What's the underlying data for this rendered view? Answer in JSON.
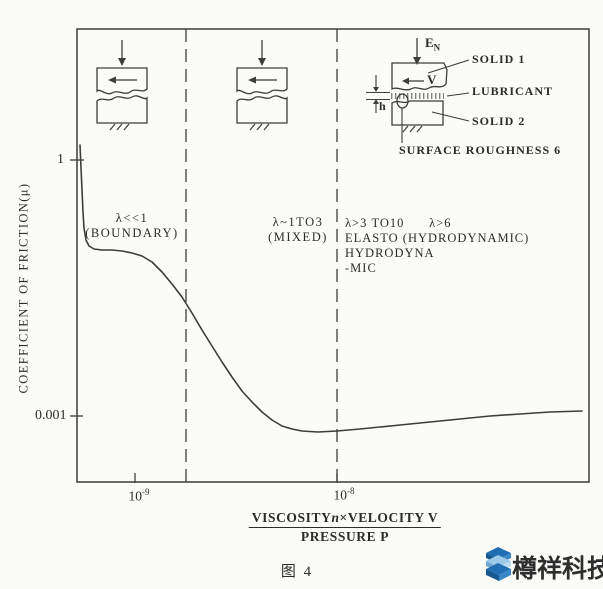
{
  "figure": {
    "caption": "图 4",
    "ink_color": "#3d3d3d",
    "background_color": "#fbfbf8"
  },
  "yaxis": {
    "title": "COEFFICIENT OF FRICTION(μ)",
    "tick_top": "1",
    "tick_bottom": "0.001"
  },
  "xaxis": {
    "tick1": {
      "base": "10",
      "exp": "-9"
    },
    "tick2": {
      "base": "10",
      "exp": "-8"
    },
    "numerator_pre": "VISCOSITY",
    "numerator_var": "n",
    "numerator_post": "×VELOCITY V",
    "denominator": "PRESSURE P"
  },
  "regions": {
    "boundary": {
      "line1": "λ<<1",
      "line2": "(BOUNDARY)"
    },
    "mixed": {
      "line1": "λ~1TO3",
      "line2": "(MIXED)"
    },
    "hydrodynamic": {
      "line1": "λ>3 TO10      λ>6",
      "line2": "ELASTO (HYDRODYNAMIC)",
      "line3": "HYDRODYNA",
      "line4": "-MIC"
    }
  },
  "inset": {
    "load_base": "E",
    "load_sub": "N",
    "velocity": "V",
    "film_thickness": "h",
    "solid1": "SOLID 1",
    "lubricant": "LUBRICANT",
    "solid2": "SOLID 2",
    "roughness": "SURFACE ROUGHNESS 6"
  },
  "watermark": {
    "text": "樽祥科技",
    "logo_dark": "#1f6db2",
    "logo_mid": "#3a87c8",
    "logo_light": "#9ccae8"
  },
  "chart_data": {
    "type": "line",
    "title": "Stribeck curve: friction regimes vs lubrication parameter",
    "xlabel": "VISCOSITY n × VELOCITY V / PRESSURE P",
    "ylabel": "COEFFICIENT OF FRICTION (μ)",
    "x_scale": "log",
    "y_scale": "log",
    "x_ticks": [
      1e-09,
      1e-08
    ],
    "y_ticks": [
      1,
      0.001
    ],
    "xlim": [
      5e-10,
      1.7e-07
    ],
    "ylim": [
      0.0005,
      2
    ],
    "grid": false,
    "legend": "none",
    "region_annotations": [
      "λ<<1 (BOUNDARY)",
      "λ~1TO3 (MIXED)",
      "λ>3 TO10 ELASTOHYDRODYNAMIC / λ>6 (HYDRODYNAMIC)"
    ],
    "series": [
      {
        "name": "coefficient of friction",
        "x": [
          5.3e-10,
          5.4e-10,
          5.6e-10,
          5.9e-10,
          6.9e-10,
          8.6e-10,
          1.1e-09,
          1.4e-09,
          1.7e-09,
          2.1e-09,
          2.7e-09,
          3.4e-09,
          4.3e-09,
          5.4e-09,
          6.7e-09,
          1e-08,
          1.6e-08,
          2.9e-08,
          5.7e-08,
          1.1e-07,
          1.6e-07
        ],
        "y": [
          1.5,
          0.51,
          0.16,
          0.098,
          0.088,
          0.086,
          0.075,
          0.049,
          0.024,
          0.01,
          0.0043,
          0.002,
          0.0011,
          0.00076,
          0.00067,
          0.00067,
          0.00075,
          0.00086,
          0.001,
          0.0011,
          0.00115
        ]
      }
    ],
    "curve_px": [
      [
        80,
        145
      ],
      [
        81,
        168
      ],
      [
        82,
        190
      ],
      [
        83,
        212
      ],
      [
        84,
        228
      ],
      [
        86,
        240
      ],
      [
        89,
        246
      ],
      [
        94,
        249
      ],
      [
        102,
        250
      ],
      [
        112,
        250
      ],
      [
        122,
        251
      ],
      [
        132,
        253
      ],
      [
        142,
        256
      ],
      [
        152,
        262
      ],
      [
        162,
        272
      ],
      [
        172,
        284
      ],
      [
        182,
        297
      ],
      [
        192,
        313
      ],
      [
        202,
        330
      ],
      [
        212,
        346
      ],
      [
        222,
        362
      ],
      [
        232,
        377
      ],
      [
        242,
        391
      ],
      [
        252,
        402
      ],
      [
        262,
        412
      ],
      [
        272,
        420
      ],
      [
        282,
        426
      ],
      [
        292,
        429
      ],
      [
        302,
        431
      ],
      [
        318,
        432
      ],
      [
        337,
        431
      ],
      [
        360,
        429
      ],
      [
        380,
        427
      ],
      [
        400,
        425
      ],
      [
        430,
        422
      ],
      [
        460,
        419
      ],
      [
        490,
        416
      ],
      [
        520,
        414
      ],
      [
        550,
        412
      ],
      [
        582,
        411
      ]
    ]
  }
}
